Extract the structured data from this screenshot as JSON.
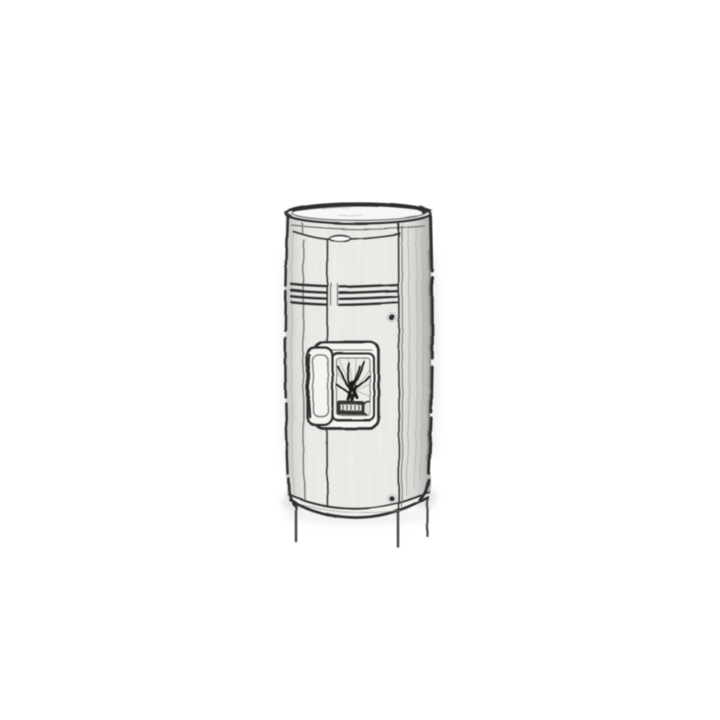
{
  "canvas": {
    "width": 720,
    "height": 720,
    "background": "#ffffff"
  },
  "figure": {
    "kind": "product-sketch",
    "alt": "Black-and-white pencil sketch of a tall cylindrical pellet stove: elliptical top rim, curved upper trim with a small center pull, a band of four horizontal grooves, a front fire door with a glass window showing a sketched flame over a burn pot and an ember stone, a vertical handle on the left of the door, two round screws on the right panel, a curved base rim and three short legs.",
    "palette": {
      "line": "#2e2e2e",
      "line_soft": "#707070",
      "line_faint": "#9a9a9a",
      "fill_light": "#f5f4f1",
      "fill_mid": "#e7e5e1",
      "glass": "#edebe6",
      "fire_dark": "#1c1c1c",
      "shadow": "#a8a6a2"
    },
    "parts": {
      "top_rim": "elliptical top rim",
      "upper_trim": "curved upper trim with center pull",
      "groove_band": "four horizontal trim grooves",
      "fire_door": "front fire door",
      "door_window": "glass viewing window with sketched flame",
      "door_handle": "vertical door handle on the left",
      "burn_pot": "burn pot with grate slots",
      "ember_stone": "round ember stone",
      "screws": "two round fasteners on the right panel",
      "base_rim": "curved base rim",
      "legs": "three short legs"
    }
  }
}
